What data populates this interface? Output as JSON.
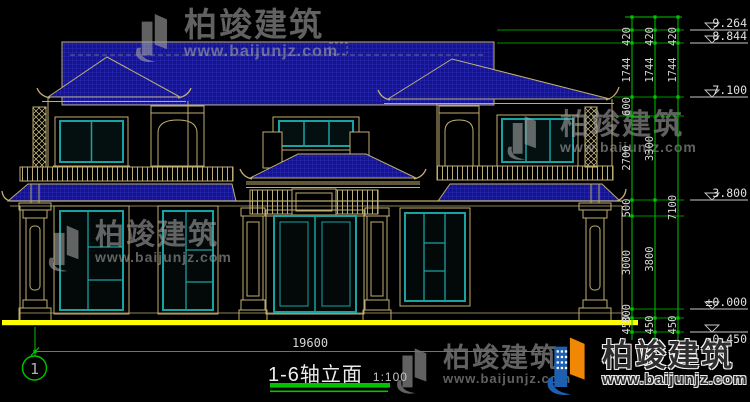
{
  "drawing": {
    "title": "1-6轴立面",
    "scale": "1:100",
    "axis_bubble_left": "1",
    "total_width_dim": "19600"
  },
  "right_dimensions": {
    "chain_inner": [
      "420",
      "1744",
      "600",
      "2700",
      "500",
      "3000",
      "300",
      "450"
    ],
    "chain_middle": [
      "420",
      "1744",
      "3300",
      "3800",
      "450"
    ],
    "chain_outer": [
      "420",
      "1744",
      "7100",
      "450"
    ],
    "elevations": [
      "9.264",
      "8.844",
      "7.100",
      "3.800",
      "±0.000",
      "-0.450"
    ]
  },
  "watermark": {
    "brand": "柏竣建筑",
    "url": "www.baijunjz.com"
  },
  "logo": {
    "brand": "柏竣建筑",
    "url": "www.baijunjz.com"
  },
  "colors": {
    "roof_fill": "#14148C",
    "roof_hatch": "#3C3CD2",
    "line_tan": "#BFAE72",
    "window_teal": "#18A2A2",
    "dim_green": "#00C400",
    "ground_yellow": "#FFFF00",
    "dim_text": "#D6D6D6",
    "logo_blue": "#1E5FB0",
    "logo_orange": "#F08705"
  }
}
